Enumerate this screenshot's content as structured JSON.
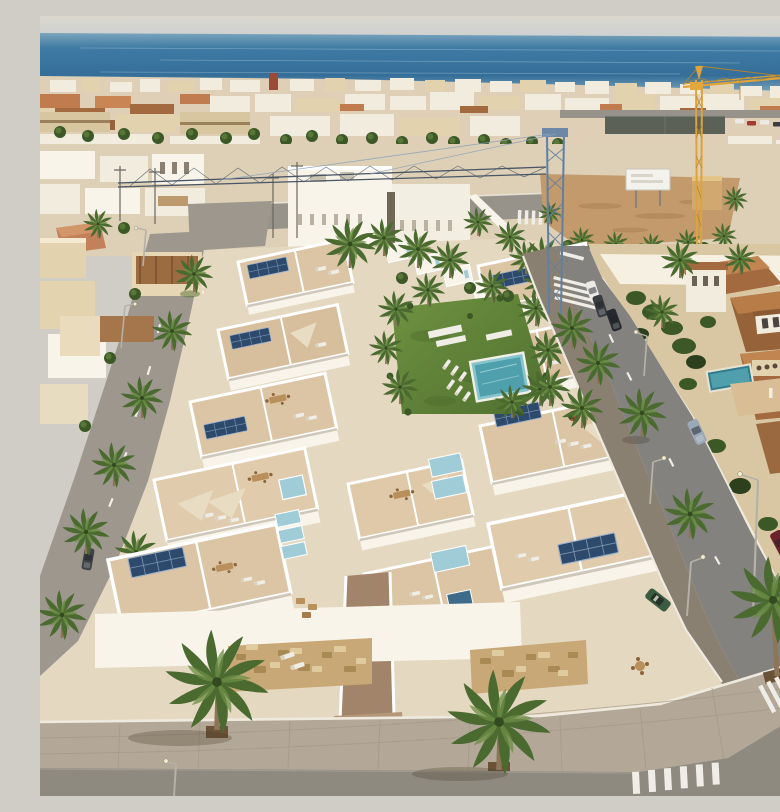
{
  "scene": {
    "type": "aerial-photograph",
    "description": "Aerial rendering of a new beachside residential development: rows of white townhouses with rooftop terraces, solar panels and a communal lawn with a swimming pool, flanked by palm-lined streets with lamps, parked cars and zebra crossings, older terracotta-roofed villas to the right, a construction crane and vacant dirt lot behind, and a dense white town skyline meeting the blue sea and hazy sky at the horizon.",
    "labels": [
      "sky",
      "sea",
      "town-skyline",
      "construction-cranes",
      "vacant-dirt-lot",
      "billboard",
      "white-townhouse-rows",
      "roof-terraces",
      "solar-panels",
      "communal-garden",
      "swimming-pool",
      "sun-loungers",
      "shade-sails",
      "palm-trees",
      "left-avenue",
      "right-street",
      "street-lamps",
      "parked-cars",
      "terracotta-villas",
      "villa-pool",
      "corner-sidewalk",
      "zebra-crossings",
      "asphalt-road",
      "stone-clad-walls"
    ]
  },
  "colors": {
    "sky_top": "#dad7ce",
    "sky_bottom": "#ccd0d1",
    "ocean_top": "#7ba4bc",
    "ocean_mid": "#3e7aa4",
    "ocean_deep": "#356f99",
    "ocean_bottom": "#84aabf",
    "far_city": "#decfb6",
    "building_white": "#f2ecdf",
    "building_cream": "#e3d2ae",
    "building_tan": "#d8c6a0",
    "trim_brown": "#9b805c",
    "terracotta": "#c07b4e",
    "terracotta_dark": "#a26a3e",
    "terracotta_deep": "#96623a",
    "white_wall": "#f8f4ea",
    "white_shadow": "#d9d3c6",
    "terrace": "#dcc5a5",
    "terrace_light": "#e9d9bd",
    "forecourt": "#c2a47e",
    "ramp": "#a1846a",
    "solar": "#2d4a6d",
    "solar_line": "#7d93ad",
    "glass": "#9fccd6",
    "glass_dark": "#3e6b8a",
    "lawn": "#6f9240",
    "lawn_dark": "#4f7030",
    "shrub": "#3c5827",
    "tree": "#55703c",
    "palm_green": "#4a6a30",
    "palm_light": "#6d8f46",
    "palm_trunk": "#8d7557",
    "pool": "#4f9fad",
    "pool_light": "#86c5cc",
    "pool_deep": "#2f7d8c",
    "dirt": "#c39a6c",
    "dirt_dark": "#a87f52",
    "road": "#97928a",
    "road_right": "#83827e",
    "road_left": "#9d978e",
    "paver_dark": "#8a8072",
    "paver_light": "#b3a897",
    "curb": "#efeadf",
    "marking": "#f0ede6",
    "crane_yellow": "#dfa33c",
    "crane_blue": "#5f7fa3",
    "truss": "#4a5666",
    "lamp": "#b5b1a8",
    "villa_wall": "#e2d2ae",
    "villa_base": "#d9c7a3",
    "stone": "#c8a876",
    "stone_dark": "#a5854f",
    "stone_light": "#e3cfa4",
    "court": "#5c6157",
    "car_white": "#eceae6",
    "car_black": "#26292e",
    "car_dark": "#3a3e43",
    "car_gray": "#8d8d8b",
    "car_red": "#6e2328",
    "car_blue": "#9aa9b6",
    "car_green": "#3b5c42",
    "furniture": "#b98f5c",
    "sail": "#e8dcc2",
    "billboard": "#f4f2ec"
  }
}
